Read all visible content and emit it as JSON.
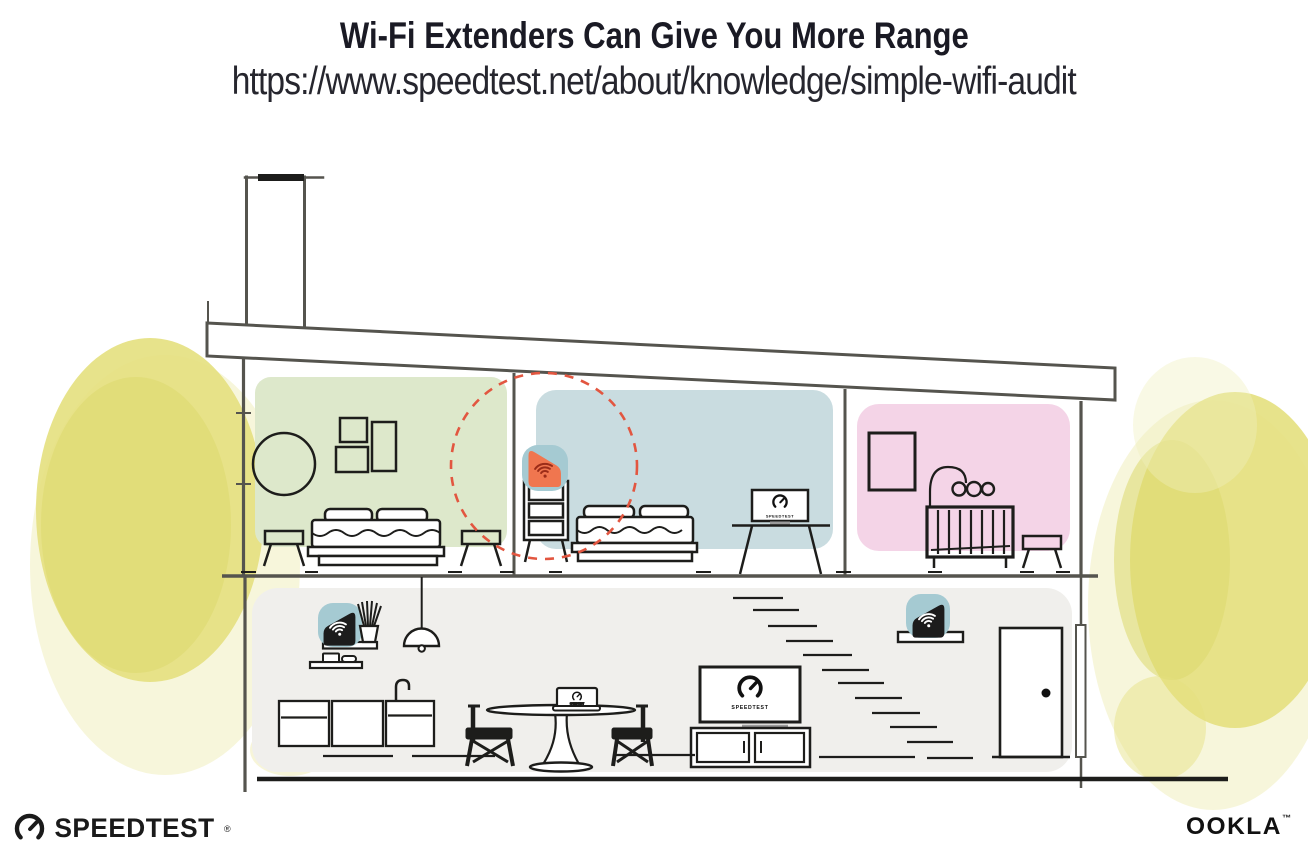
{
  "header": {
    "title": "Wi-Fi Extenders Can Give You More Range",
    "url": "https://www.speedtest.net/about/knowledge/simple-wifi-audit"
  },
  "house": {
    "description": "Cross-section of a two-story house: upstairs green bedroom, blue bedroom with a Wi-Fi extender highlighted by a red dashed coverage circle, pink nursery; downstairs kitchen and living room with a Wi-Fi router on a shelf, a second extender near the stairs, TVs and a laptop running Speedtest.",
    "tv_label": "SPEEDTEST",
    "extenders": [
      {
        "location": "upstairs-middle-bedroom-dresser",
        "state": "highlighted-orange"
      },
      {
        "location": "downstairs-left-wall-shelf",
        "state": "black"
      },
      {
        "location": "downstairs-right-wall-shelf",
        "state": "black"
      }
    ],
    "icons": [
      "wifi-signal-icon",
      "speedtest-gauge-icon",
      "coverage-circle"
    ]
  },
  "footer": {
    "speedtest_label": "SPEEDTEST",
    "speedtest_mark": "®",
    "ookla_label": "OOKLA",
    "ookla_mark": "™"
  },
  "colors": {
    "title_text": "#1a1a24",
    "url_text": "#26262e",
    "line": "#55544e",
    "ink": "#1d1d1b",
    "room_green": "#dde8cb",
    "room_blue": "#c9dce0",
    "room_pink": "#f4d4e7",
    "floor_gray": "#f0efec",
    "extender_teal": "#a5cad2",
    "extender_orange": "#f0764f",
    "wifi_dark_red": "#9c2c18",
    "coverage_red": "#e25640",
    "foliage": "#e4e07e",
    "foliage_dark": "#dcd96e",
    "foliage_light": "#f1efbe"
  }
}
